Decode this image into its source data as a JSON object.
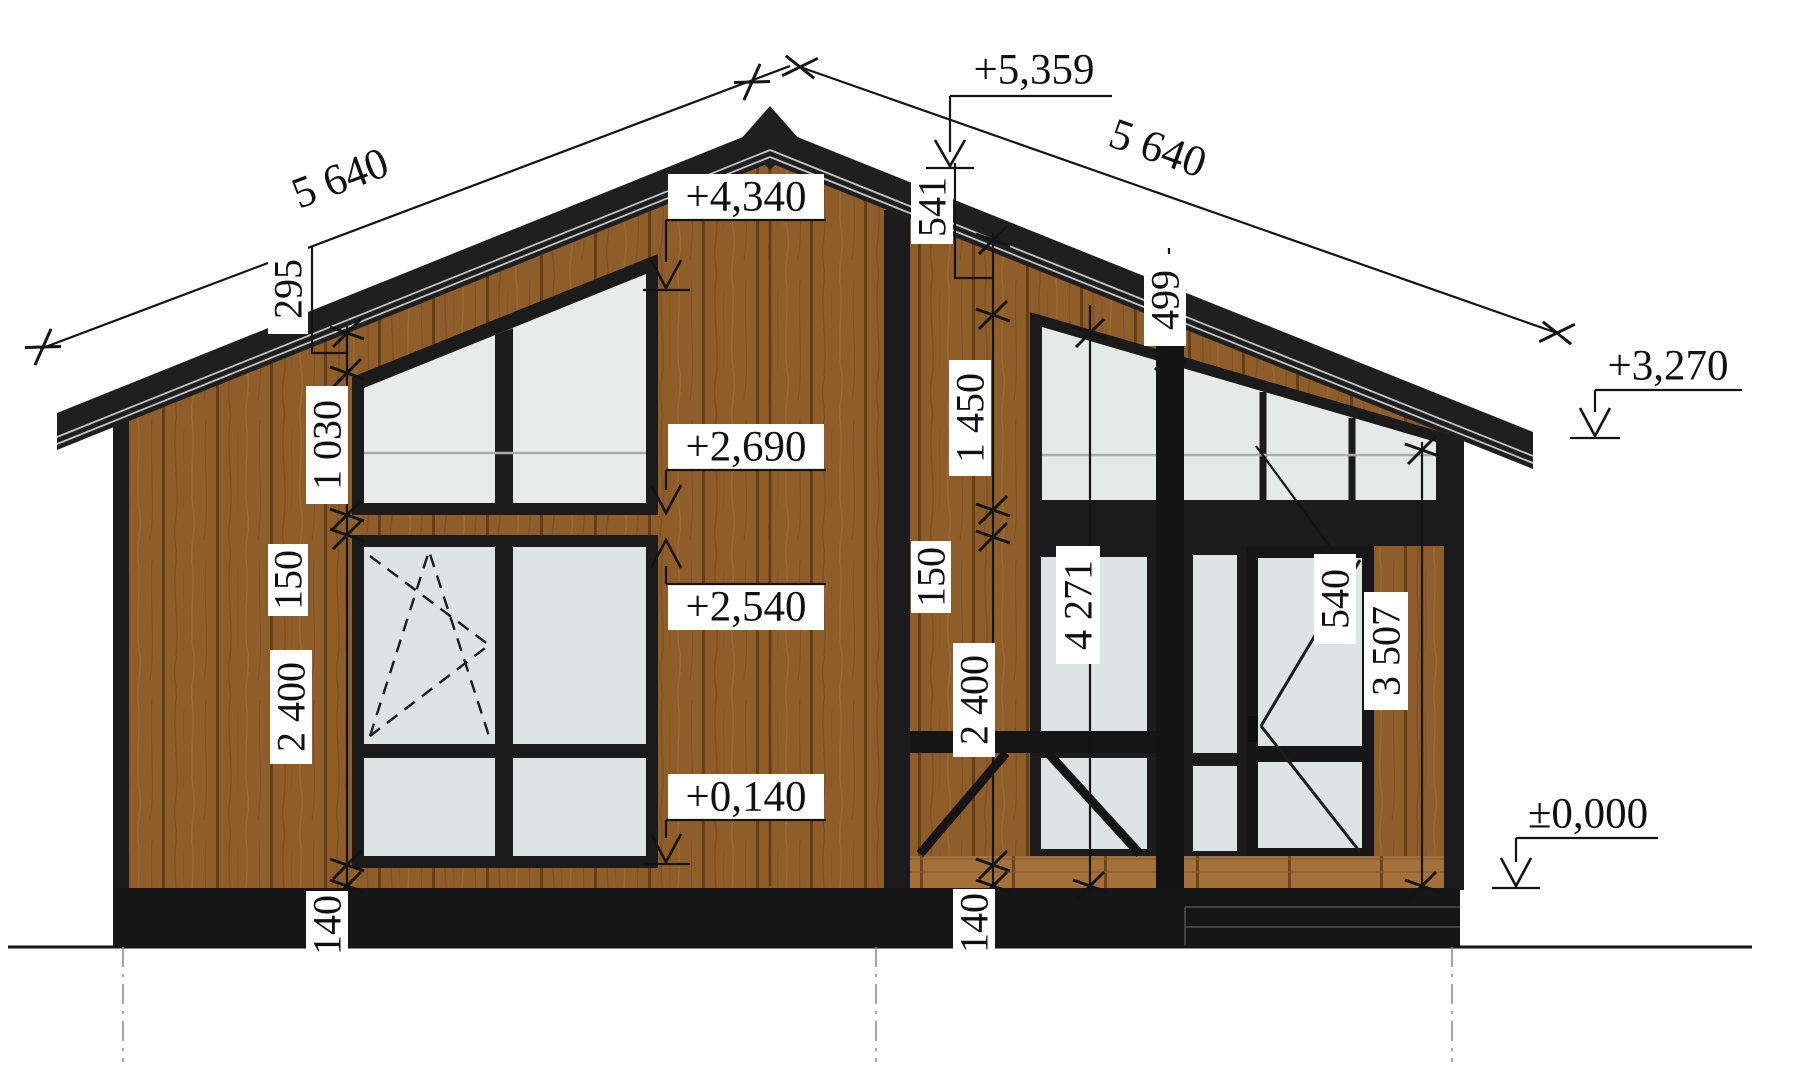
{
  "drawing": {
    "title": "house-front-elevation",
    "colors": {
      "wood": "#8f5d2a",
      "wood_seam": "#60401c",
      "deck_wood": "#a4713a",
      "frame_black": "#1b1b1c",
      "roof_black": "#1f1f20",
      "plinth_black": "#161616",
      "glass_lower": "#dde4e4",
      "glass_upper": "#e7ecea",
      "glass_clerestory": "#e4eae8",
      "dim_line": "#141414",
      "label_bg": "#ffffff",
      "centerline": "#909090"
    },
    "dims": {
      "roof_left": "5 640",
      "roof_right": "5 640",
      "eave_offset": "295",
      "gable_window_height": "1 030",
      "left_gap": "150",
      "left_window_height": "2 400",
      "left_floor_thickness": "140",
      "ridge_offset": "541",
      "clerestory_height": "1 450",
      "center_gap": "150",
      "center_window_height": "2 400",
      "center_floor_thickness": "140",
      "roof_gap": "499",
      "clerestory_end_height": "540",
      "glazing_total_height": "4 271",
      "right_wall_height": "3 507"
    },
    "levels": {
      "ridge": "+5,359",
      "gable_window_top": "+4,340",
      "gable_window_bottom": "+2,690",
      "window_head": "+2,540",
      "window_sill": "+0,140",
      "right_eave": "+3,270",
      "ground_floor": "±0,000"
    }
  }
}
